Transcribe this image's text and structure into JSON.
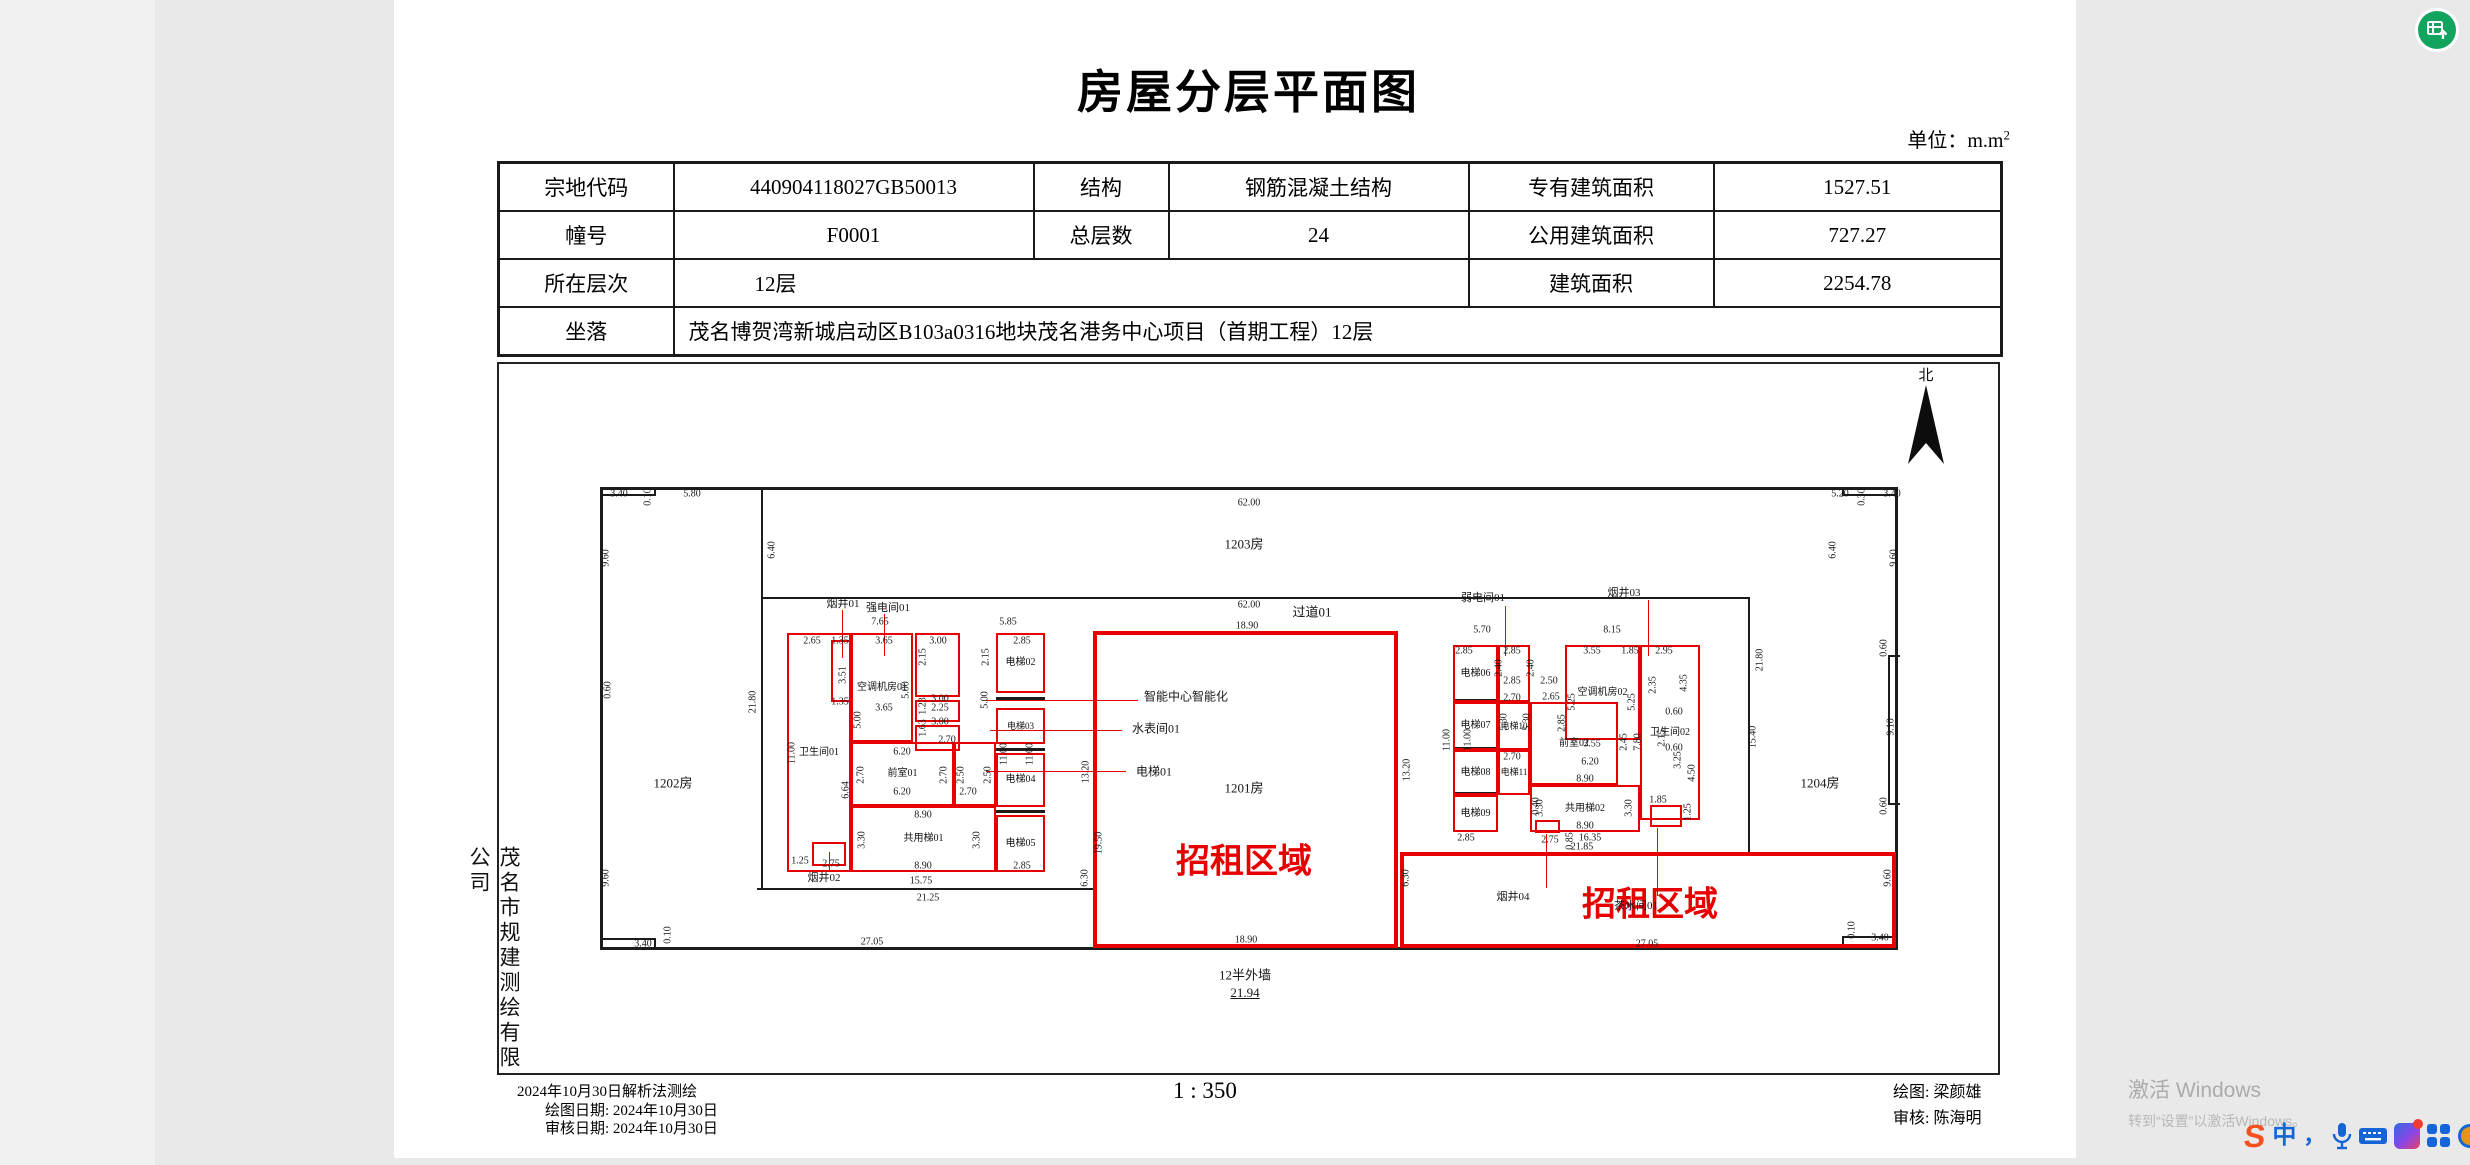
{
  "colors": {
    "accent_red": "#e60000",
    "line_black": "#1c1c1c",
    "fab_green": "#12a35f",
    "taskbar_blue": "#1565d8",
    "watermark_gray": "#ababab"
  },
  "page": {
    "title": "房屋分层平面图",
    "unit_label": "单位：m.m",
    "unit_sup": "2",
    "scale_label": "1 : 350",
    "company_vertical": "茂名市规建测绘有限公司",
    "survey_note": "2024年10月30日解析法测绘",
    "draw_date": "绘图日期: 2024年10月30日",
    "review_date": "审核日期: 2024年10月30日",
    "drafter": "绘图: 梁颜雄",
    "reviewer": "审核: 陈海明",
    "north_label": "北"
  },
  "watermark": {
    "line1": "激活 Windows",
    "line2": "转到“设置”以激活Windows。"
  },
  "table": {
    "r1c1": "宗地代码",
    "r1c2": "440904118027GB50013",
    "r1c3": "结构",
    "r1c4": "钢筋混凝土结构",
    "r1c5": "专有建筑面积",
    "r1c6": "1527.51",
    "r2c1": "幢号",
    "r2c2": "F0001",
    "r2c3": "总层数",
    "r2c4": "24",
    "r2c5": "公用建筑面积",
    "r2c6": "727.27",
    "r3c1": "所在层次",
    "r3c2": "12层",
    "r3c5": "建筑面积",
    "r3c6": "2254.78",
    "r4c1": "坐落",
    "r4c2": "茂名博贺湾新城启动区B103a0316地块茂名港务中心项目（首期工程）12层"
  },
  "plan": {
    "black_boxes": [
      {
        "x": 600,
        "y": 487,
        "w": 1298,
        "h": 463
      }
    ],
    "black_lines": [
      {
        "x": 761,
        "y": 487,
        "w": 2,
        "h": 403
      },
      {
        "x": 761,
        "y": 597,
        "w": 989,
        "h": 2
      },
      {
        "x": 1748,
        "y": 597,
        "w": 2,
        "h": 255
      },
      {
        "x": 757,
        "y": 888,
        "w": 338,
        "h": 2
      },
      {
        "x": 600,
        "y": 494,
        "w": 56,
        "h": 2
      },
      {
        "x": 654,
        "y": 487,
        "w": 2,
        "h": 9
      },
      {
        "x": 600,
        "y": 938,
        "w": 56,
        "h": 2
      },
      {
        "x": 654,
        "y": 938,
        "w": 2,
        "h": 12
      },
      {
        "x": 1842,
        "y": 494,
        "w": 56,
        "h": 2
      },
      {
        "x": 1842,
        "y": 487,
        "w": 2,
        "h": 9
      },
      {
        "x": 1842,
        "y": 936,
        "w": 56,
        "h": 2
      },
      {
        "x": 1842,
        "y": 936,
        "w": 2,
        "h": 14
      },
      {
        "x": 1888,
        "y": 655,
        "w": 2,
        "h": 150
      },
      {
        "x": 1888,
        "y": 655,
        "w": 12,
        "h": 2
      },
      {
        "x": 1888,
        "y": 803,
        "w": 12,
        "h": 2
      },
      {
        "x": 996,
        "y": 697,
        "w": 49,
        "h": 3
      },
      {
        "x": 996,
        "y": 748,
        "w": 49,
        "h": 3
      },
      {
        "x": 996,
        "y": 810,
        "w": 49,
        "h": 3
      },
      {
        "x": 1453,
        "y": 699,
        "w": 45,
        "h": 3
      },
      {
        "x": 1453,
        "y": 747,
        "w": 45,
        "h": 3
      },
      {
        "x": 1453,
        "y": 792,
        "w": 45,
        "h": 3
      }
    ],
    "red_lines": [
      {
        "x": 842,
        "y": 610,
        "w": 1,
        "h": 48
      },
      {
        "x": 884,
        "y": 614,
        "w": 1,
        "h": 42
      },
      {
        "x": 986,
        "y": 700,
        "w": 152,
        "h": 1
      },
      {
        "x": 990,
        "y": 730,
        "w": 132,
        "h": 1
      },
      {
        "x": 986,
        "y": 771,
        "w": 140,
        "h": 1
      },
      {
        "x": 1505,
        "y": 606,
        "w": 1,
        "h": 50
      },
      {
        "x": 1648,
        "y": 600,
        "w": 1,
        "h": 56
      },
      {
        "x": 829,
        "y": 852,
        "w": 1,
        "h": 18
      },
      {
        "x": 1546,
        "y": 834,
        "w": 1,
        "h": 54
      },
      {
        "x": 1657,
        "y": 828,
        "w": 1,
        "h": 68
      }
    ],
    "rooms": [
      {
        "x": 787,
        "y": 633,
        "w": 64,
        "h": 239,
        "l": "卫生间01",
        "fs": 10
      },
      {
        "x": 831,
        "y": 640,
        "w": 22,
        "h": 62
      },
      {
        "x": 851,
        "y": 633,
        "w": 62,
        "h": 109,
        "l": "空调机房01",
        "fs": 10
      },
      {
        "x": 915,
        "y": 633,
        "w": 45,
        "h": 64
      },
      {
        "x": 915,
        "y": 700,
        "w": 45,
        "h": 22
      },
      {
        "x": 915,
        "y": 725,
        "w": 45,
        "h": 26
      },
      {
        "x": 851,
        "y": 742,
        "w": 103,
        "h": 64,
        "l": "前室01",
        "fs": 10
      },
      {
        "x": 954,
        "y": 742,
        "w": 42,
        "h": 64
      },
      {
        "x": 851,
        "y": 806,
        "w": 145,
        "h": 66,
        "l": "共用梯01",
        "fs": 10
      },
      {
        "x": 996,
        "y": 633,
        "w": 49,
        "h": 60,
        "l": "电梯02",
        "fs": 10
      },
      {
        "x": 996,
        "y": 708,
        "w": 49,
        "h": 36,
        "l": "电梯03",
        "fs": 9
      },
      {
        "x": 996,
        "y": 753,
        "w": 49,
        "h": 54,
        "l": "电梯04",
        "fs": 10
      },
      {
        "x": 996,
        "y": 815,
        "w": 49,
        "h": 57,
        "l": "电梯05",
        "fs": 10
      },
      {
        "x": 812,
        "y": 842,
        "w": 34,
        "h": 24
      },
      {
        "x": 1453,
        "y": 645,
        "w": 45,
        "h": 57,
        "l": "电梯06",
        "fs": 10
      },
      {
        "x": 1498,
        "y": 645,
        "w": 32,
        "h": 57
      },
      {
        "x": 1453,
        "y": 702,
        "w": 45,
        "h": 48,
        "l": "电梯07",
        "fs": 10
      },
      {
        "x": 1498,
        "y": 702,
        "w": 32,
        "h": 48,
        "l": "电梯10",
        "fs": 9
      },
      {
        "x": 1453,
        "y": 750,
        "w": 45,
        "h": 45,
        "l": "电梯08",
        "fs": 10
      },
      {
        "x": 1498,
        "y": 750,
        "w": 32,
        "h": 45,
        "l": "电梯11",
        "fs": 9
      },
      {
        "x": 1453,
        "y": 795,
        "w": 45,
        "h": 37,
        "l": "电梯09",
        "fs": 10
      },
      {
        "x": 1565,
        "y": 645,
        "w": 75,
        "h": 95,
        "l": "空调机房02",
        "fs": 10
      },
      {
        "x": 1530,
        "y": 702,
        "w": 88,
        "h": 83,
        "l": "前室02",
        "fs": 10
      },
      {
        "x": 1530,
        "y": 785,
        "w": 110,
        "h": 47,
        "l": "共用梯02",
        "fs": 10
      },
      {
        "x": 1640,
        "y": 645,
        "w": 60,
        "h": 175,
        "l": "卫生间02",
        "fs": 10
      },
      {
        "x": 1650,
        "y": 805,
        "w": 32,
        "h": 22
      },
      {
        "x": 1535,
        "y": 820,
        "w": 25,
        "h": 13
      },
      {
        "x": 1093,
        "y": 631,
        "w": 305,
        "h": 317,
        "cls": "lease"
      },
      {
        "x": 1400,
        "y": 852,
        "w": 496,
        "h": 96,
        "cls": "lease"
      }
    ],
    "labels": [
      {
        "t": "1202房",
        "x": 673,
        "y": 782,
        "s": 13,
        "n": "room-area-label"
      },
      {
        "t": "1203房",
        "x": 1244,
        "y": 543,
        "s": 13,
        "n": "room-area-label"
      },
      {
        "t": "过道01",
        "x": 1312,
        "y": 611,
        "s": 13,
        "n": "room-area-label"
      },
      {
        "t": "1201房",
        "x": 1244,
        "y": 787,
        "s": 13,
        "n": "room-area-label"
      },
      {
        "t": "1204房",
        "x": 1820,
        "y": 782,
        "s": 13,
        "n": "room-area-label"
      },
      {
        "t": "招租区域",
        "x": 1244,
        "y": 858,
        "s": 34,
        "c": "#e60000",
        "b": 1,
        "n": "lease-area-label"
      },
      {
        "t": "招租区域",
        "x": 1650,
        "y": 901,
        "s": 34,
        "c": "#e60000",
        "b": 1,
        "n": "lease-area-label"
      },
      {
        "t": "12半外墙",
        "x": 1245,
        "y": 974,
        "s": 13,
        "n": "outer-wall-note"
      },
      {
        "t": "21.94",
        "x": 1245,
        "y": 993,
        "s": 13,
        "u": 1,
        "n": "outer-wall-dimension"
      },
      {
        "t": "智能中心智能化",
        "x": 1186,
        "y": 696,
        "s": 12,
        "n": "callout-label"
      },
      {
        "t": "水表间01",
        "x": 1156,
        "y": 728,
        "s": 12,
        "n": "callout-label"
      },
      {
        "t": "电梯01",
        "x": 1154,
        "y": 771,
        "s": 12,
        "n": "callout-label"
      },
      {
        "t": "烟井01",
        "x": 843,
        "y": 603,
        "s": 11,
        "n": "callout-label"
      },
      {
        "t": "强电间01",
        "x": 888,
        "y": 607,
        "s": 11,
        "n": "callout-label"
      },
      {
        "t": "弱电间01",
        "x": 1483,
        "y": 597,
        "s": 11,
        "n": "callout-label"
      },
      {
        "t": "烟井03",
        "x": 1624,
        "y": 592,
        "s": 11,
        "n": "callout-label"
      },
      {
        "t": "烟井02",
        "x": 824,
        "y": 877,
        "s": 11,
        "n": "callout-label"
      },
      {
        "t": "烟井04",
        "x": 1513,
        "y": 896,
        "s": 11,
        "n": "callout-label"
      },
      {
        "t": "茶水间01",
        "x": 1636,
        "y": 905,
        "s": 11,
        "n": "callout-label"
      },
      {
        "t": "3.40",
        "x": 619,
        "y": 494
      },
      {
        "t": "0.10",
        "x": 648,
        "y": 497,
        "r": 1
      },
      {
        "t": "5.80",
        "x": 692,
        "y": 494
      },
      {
        "t": "9.60",
        "x": 606,
        "y": 558,
        "r": 1
      },
      {
        "t": "0.60",
        "x": 608,
        "y": 690,
        "r": 1
      },
      {
        "t": "6.40",
        "x": 772,
        "y": 550,
        "r": 1
      },
      {
        "t": "21.80",
        "x": 753,
        "y": 702,
        "r": 1
      },
      {
        "t": "62.00",
        "x": 1249,
        "y": 503
      },
      {
        "t": "62.00",
        "x": 1249,
        "y": 605
      },
      {
        "t": "18.90",
        "x": 1247,
        "y": 626
      },
      {
        "t": "5.20",
        "x": 1840,
        "y": 494
      },
      {
        "t": "0.30",
        "x": 1862,
        "y": 497,
        "r": 1
      },
      {
        "t": "3.40",
        "x": 1892,
        "y": 494
      },
      {
        "t": "6.40",
        "x": 1833,
        "y": 550,
        "r": 1
      },
      {
        "t": "9.60",
        "x": 1894,
        "y": 558,
        "r": 1
      },
      {
        "t": "21.80",
        "x": 1760,
        "y": 660,
        "r": 1
      },
      {
        "t": "15.40",
        "x": 1753,
        "y": 737,
        "r": 1
      },
      {
        "t": "0.60",
        "x": 1884,
        "y": 648,
        "r": 1
      },
      {
        "t": "9.10",
        "x": 1891,
        "y": 727,
        "r": 1
      },
      {
        "t": "0.60",
        "x": 1884,
        "y": 806,
        "r": 1
      },
      {
        "t": "9.60",
        "x": 606,
        "y": 878,
        "r": 1
      },
      {
        "t": "3.40",
        "x": 643,
        "y": 944
      },
      {
        "t": "0.10",
        "x": 668,
        "y": 935,
        "r": 1
      },
      {
        "t": "27.05",
        "x": 872,
        "y": 942
      },
      {
        "t": "21.25",
        "x": 928,
        "y": 898
      },
      {
        "t": "15.75",
        "x": 921,
        "y": 881
      },
      {
        "t": "6.30",
        "x": 1085,
        "y": 878,
        "r": 1
      },
      {
        "t": "13.20",
        "x": 1086,
        "y": 772,
        "r": 1
      },
      {
        "t": "19.50",
        "x": 1099,
        "y": 843,
        "r": 1
      },
      {
        "t": "13.20",
        "x": 1407,
        "y": 770,
        "r": 1
      },
      {
        "t": "18.90",
        "x": 1246,
        "y": 940
      },
      {
        "t": "6.30",
        "x": 1406,
        "y": 878,
        "r": 1
      },
      {
        "t": "27.05",
        "x": 1647,
        "y": 944
      },
      {
        "t": "9.60",
        "x": 1888,
        "y": 878,
        "r": 1
      },
      {
        "t": "0.10",
        "x": 1852,
        "y": 930,
        "r": 1
      },
      {
        "t": "3.40",
        "x": 1880,
        "y": 938
      },
      {
        "t": "7.65",
        "x": 880,
        "y": 622
      },
      {
        "t": "5.85",
        "x": 1008,
        "y": 622
      },
      {
        "t": "2.65",
        "x": 812,
        "y": 641
      },
      {
        "t": "1.35",
        "x": 840,
        "y": 641
      },
      {
        "t": "3.65",
        "x": 884,
        "y": 641
      },
      {
        "t": "3.00",
        "x": 938,
        "y": 641
      },
      {
        "t": "2.85",
        "x": 1022,
        "y": 641
      },
      {
        "t": "2.15",
        "x": 923,
        "y": 657,
        "r": 1
      },
      {
        "t": "2.15",
        "x": 986,
        "y": 657,
        "r": 1
      },
      {
        "t": "3.51",
        "x": 843,
        "y": 675,
        "r": 1
      },
      {
        "t": "1.35",
        "x": 840,
        "y": 702
      },
      {
        "t": "5.00",
        "x": 858,
        "y": 720,
        "r": 1
      },
      {
        "t": "5.00",
        "x": 906,
        "y": 690,
        "r": 1
      },
      {
        "t": "5.00",
        "x": 985,
        "y": 700,
        "r": 1
      },
      {
        "t": "3.65",
        "x": 884,
        "y": 708
      },
      {
        "t": "2.25",
        "x": 940,
        "y": 708
      },
      {
        "t": "1.23",
        "x": 923,
        "y": 706,
        "r": 1
      },
      {
        "t": "3.00",
        "x": 940,
        "y": 699
      },
      {
        "t": "1.63",
        "x": 923,
        "y": 728,
        "r": 1
      },
      {
        "t": "3.00",
        "x": 940,
        "y": 722
      },
      {
        "t": "2.70",
        "x": 947,
        "y": 740
      },
      {
        "t": "6.20",
        "x": 902,
        "y": 752
      },
      {
        "t": "2.70",
        "x": 861,
        "y": 775,
        "r": 1
      },
      {
        "t": "2.70",
        "x": 944,
        "y": 775,
        "r": 1
      },
      {
        "t": "2.50",
        "x": 961,
        "y": 775,
        "r": 1
      },
      {
        "t": "2.50",
        "x": 988,
        "y": 775,
        "r": 1
      },
      {
        "t": "2.70",
        "x": 968,
        "y": 792
      },
      {
        "t": "6.20",
        "x": 902,
        "y": 792
      },
      {
        "t": "11.00",
        "x": 1004,
        "y": 754,
        "r": 1
      },
      {
        "t": "11.00",
        "x": 1030,
        "y": 754,
        "r": 1
      },
      {
        "t": "11.00",
        "x": 792,
        "y": 753,
        "r": 1
      },
      {
        "t": "6.64",
        "x": 846,
        "y": 790,
        "r": 1
      },
      {
        "t": "8.90",
        "x": 923,
        "y": 815
      },
      {
        "t": "3.30",
        "x": 862,
        "y": 840,
        "r": 1
      },
      {
        "t": "3.30",
        "x": 977,
        "y": 840,
        "r": 1
      },
      {
        "t": "8.90",
        "x": 923,
        "y": 866
      },
      {
        "t": "2.85",
        "x": 1022,
        "y": 866
      },
      {
        "t": "1.25",
        "x": 800,
        "y": 861
      },
      {
        "t": "2.75",
        "x": 831,
        "y": 864
      },
      {
        "t": "5.70",
        "x": 1482,
        "y": 630
      },
      {
        "t": "8.15",
        "x": 1612,
        "y": 630
      },
      {
        "t": "2.85",
        "x": 1464,
        "y": 651
      },
      {
        "t": "2.85",
        "x": 1512,
        "y": 651
      },
      {
        "t": "2.40",
        "x": 1499,
        "y": 668,
        "r": 1
      },
      {
        "t": "2.40",
        "x": 1531,
        "y": 668,
        "r": 1
      },
      {
        "t": "2.85",
        "x": 1512,
        "y": 681
      },
      {
        "t": "2.50",
        "x": 1549,
        "y": 681
      },
      {
        "t": "2.65",
        "x": 1551,
        "y": 697
      },
      {
        "t": "3.55",
        "x": 1592,
        "y": 651
      },
      {
        "t": "1.85",
        "x": 1630,
        "y": 651
      },
      {
        "t": "2.95",
        "x": 1664,
        "y": 651
      },
      {
        "t": "2.35",
        "x": 1653,
        "y": 685,
        "r": 1
      },
      {
        "t": "4.35",
        "x": 1684,
        "y": 683,
        "r": 1
      },
      {
        "t": "5.25",
        "x": 1572,
        "y": 702,
        "r": 1
      },
      {
        "t": "5.25",
        "x": 1632,
        "y": 702,
        "r": 1
      },
      {
        "t": "2.85",
        "x": 1562,
        "y": 723,
        "r": 1
      },
      {
        "t": "3.55",
        "x": 1592,
        "y": 744
      },
      {
        "t": "0.60",
        "x": 1674,
        "y": 712
      },
      {
        "t": "2.15",
        "x": 1662,
        "y": 738,
        "r": 1
      },
      {
        "t": "2.70",
        "x": 1512,
        "y": 698
      },
      {
        "t": "5.30",
        "x": 1504,
        "y": 722,
        "r": 1
      },
      {
        "t": "5.30",
        "x": 1527,
        "y": 722,
        "r": 1
      },
      {
        "t": "11.00",
        "x": 1447,
        "y": 740,
        "r": 1
      },
      {
        "t": "11.00",
        "x": 1468,
        "y": 740,
        "r": 1
      },
      {
        "t": "2.70",
        "x": 1512,
        "y": 757
      },
      {
        "t": "2.45",
        "x": 1624,
        "y": 742,
        "r": 1
      },
      {
        "t": "7.80",
        "x": 1638,
        "y": 742,
        "r": 1
      },
      {
        "t": "6.20",
        "x": 1590,
        "y": 762
      },
      {
        "t": "8.90",
        "x": 1585,
        "y": 779
      },
      {
        "t": "3.30",
        "x": 1540,
        "y": 808,
        "r": 1
      },
      {
        "t": "3.30",
        "x": 1629,
        "y": 808,
        "r": 1
      },
      {
        "t": "8.90",
        "x": 1585,
        "y": 826
      },
      {
        "t": "0.60",
        "x": 1674,
        "y": 748
      },
      {
        "t": "3.25",
        "x": 1678,
        "y": 760,
        "r": 1
      },
      {
        "t": "4.50",
        "x": 1692,
        "y": 773,
        "r": 1
      },
      {
        "t": "1.85",
        "x": 1658,
        "y": 800
      },
      {
        "t": "1.25",
        "x": 1688,
        "y": 812,
        "r": 1
      },
      {
        "t": "2.75",
        "x": 1550,
        "y": 840
      },
      {
        "t": "0.85",
        "x": 1570,
        "y": 841,
        "r": 1
      },
      {
        "t": "0.40",
        "x": 1536,
        "y": 806,
        "r": 1
      },
      {
        "t": "2.85",
        "x": 1466,
        "y": 838
      },
      {
        "t": "16.35",
        "x": 1590,
        "y": 838
      },
      {
        "t": "21.85",
        "x": 1582,
        "y": 847
      }
    ]
  }
}
